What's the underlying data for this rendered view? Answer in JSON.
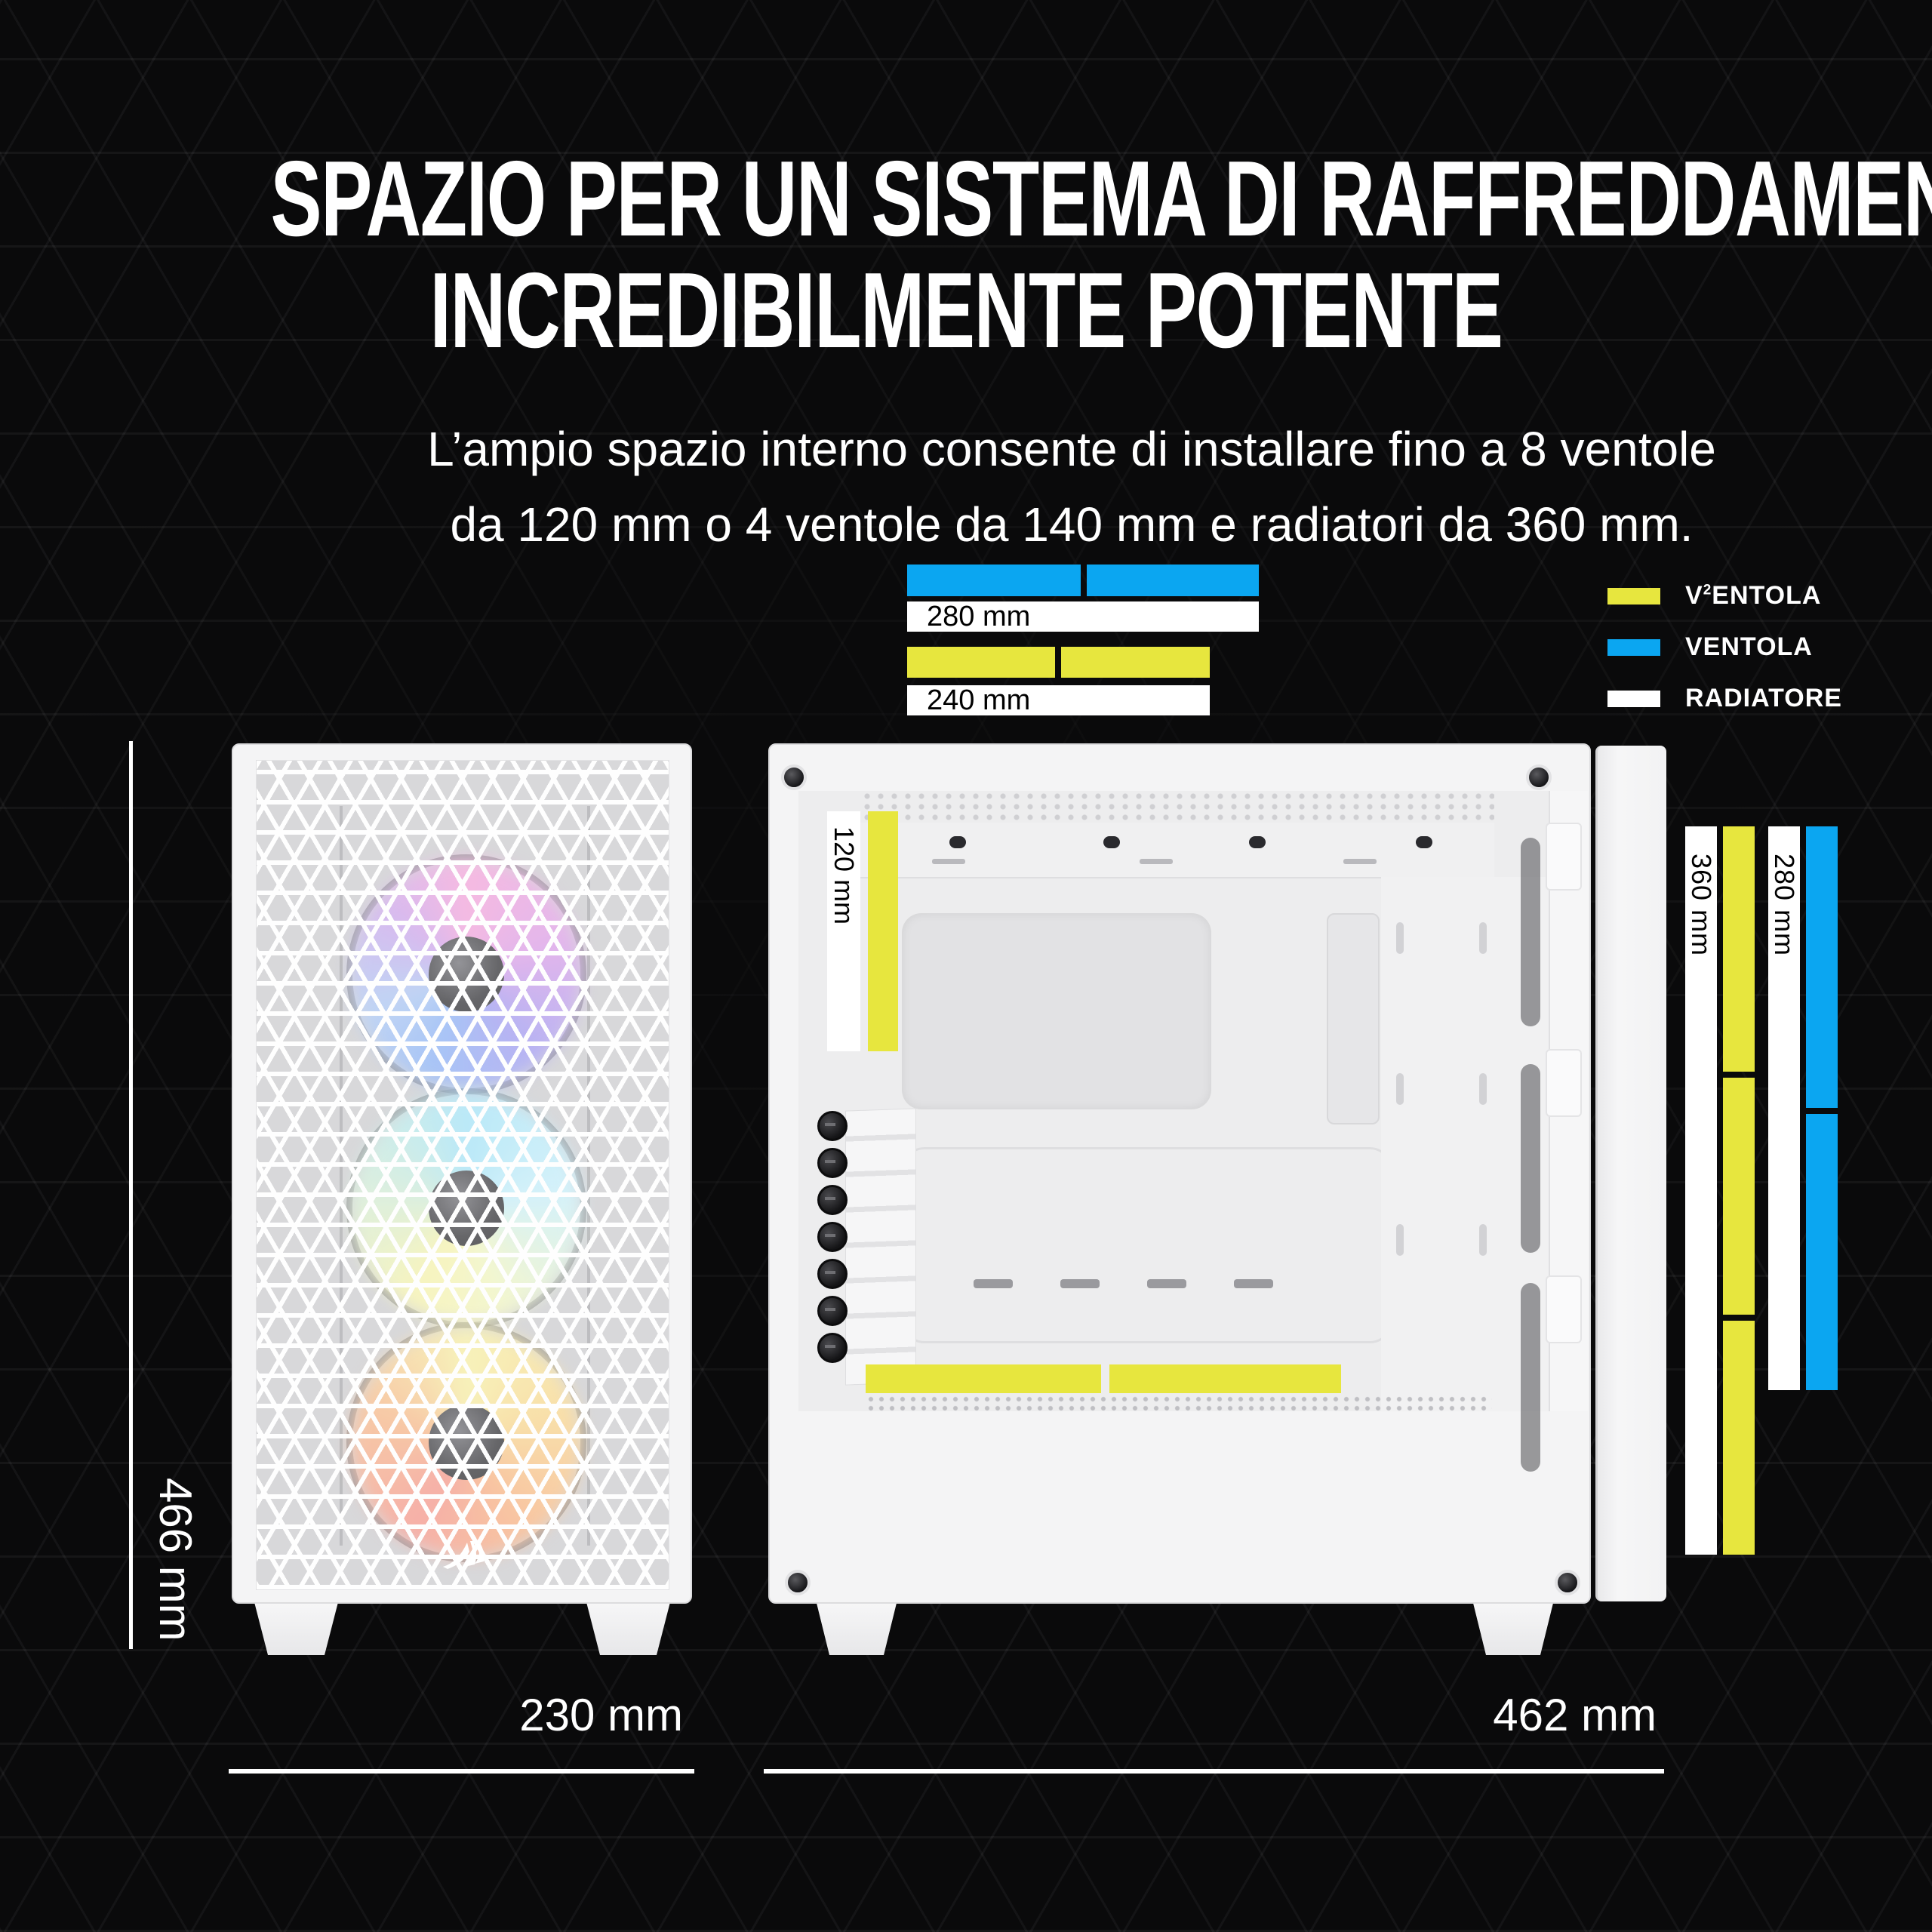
{
  "title": {
    "line1": "SPAZIO PER UN SISTEMA DI RAFFREDDAMENTO",
    "line2": "INCREDIBILMENTE POTENTE"
  },
  "subtitle": {
    "line1": "L’ampio spazio interno consente di installare fino a 8 ventole",
    "line2": "da 120 mm o 4 ventole da 140 mm e radiatori da 360 mm."
  },
  "legend": {
    "items": [
      {
        "color": "#E7E63E",
        "color_name": "yellow",
        "pre": "V",
        "sup": "2",
        "post": "ENTOLA"
      },
      {
        "color": "#0BA6F1",
        "color_name": "blue",
        "pre": "VENTOLA",
        "sup": "",
        "post": ""
      },
      {
        "color": "#FFFFFF",
        "color_name": "white",
        "pre": "RADIATORE",
        "sup": "",
        "post": ""
      }
    ]
  },
  "gauges": {
    "top": {
      "fan_blue_segments": 2,
      "radiator_280_label": "280 mm",
      "fan_yellow_segments": 2,
      "radiator_240_label": "240 mm"
    },
    "side_interior": {
      "rear_fan_label": "120 mm",
      "bottom_fan_segments": 2
    },
    "right": {
      "radiator_360_label": "360 mm",
      "fan_yellow_segments": 3,
      "radiator_280_label": "280 mm",
      "fan_blue_segments": 2
    }
  },
  "dimensions": {
    "case_height": "466 mm",
    "front_width": "230 mm",
    "side_depth": "462 mm"
  },
  "colors": {
    "background": "#0A0A0B",
    "fan_yellow": "#E7E63E",
    "fan_blue": "#0BA6F1",
    "radiator": "#FFFFFF",
    "case": "#F4F4F5",
    "text": "#FFFFFF"
  },
  "icons": {
    "brand_logo": "corsair-sails-logo"
  }
}
